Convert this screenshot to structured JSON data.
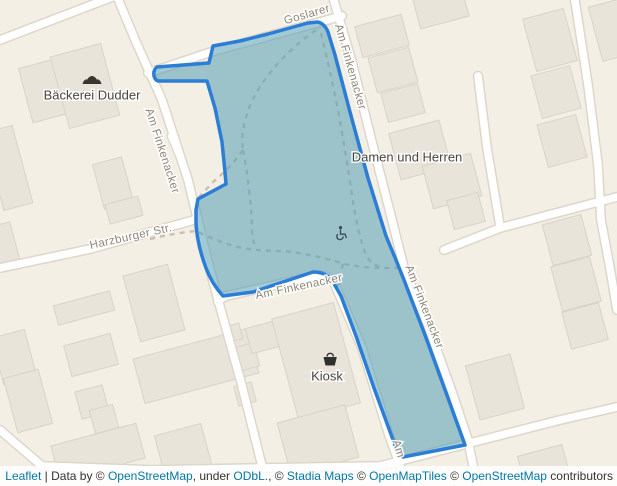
{
  "map": {
    "street_labels": [
      {
        "text": "Goslarer"
      },
      {
        "text": "Am Finkenacker"
      },
      {
        "text": "Am Finkenacker"
      },
      {
        "text": "Am Finkenacker"
      },
      {
        "text": "Am Finkenacker"
      },
      {
        "text": "Am"
      },
      {
        "text": "Harzburger Str."
      }
    ],
    "poi_labels": [
      {
        "text": "Bäckerei Dudder",
        "icon": "bakery-icon"
      },
      {
        "text": "Damen und Herren",
        "icon": "none"
      },
      {
        "text": "Kiosk",
        "icon": "shopping-basket-icon"
      }
    ],
    "icons": [
      {
        "name": "bakery-icon"
      },
      {
        "name": "wheelchair-icon"
      },
      {
        "name": "shopping-basket-icon"
      }
    ]
  },
  "attribution": {
    "parts": [
      {
        "text": "Leaflet",
        "link": true
      },
      {
        "text": " | Data by © ",
        "link": false
      },
      {
        "text": "OpenStreetMap",
        "link": true
      },
      {
        "text": ", under ",
        "link": false
      },
      {
        "text": "ODbL.",
        "link": true
      },
      {
        "text": ", © ",
        "link": false
      },
      {
        "text": "Stadia Maps",
        "link": true
      },
      {
        "text": " © ",
        "link": false
      },
      {
        "text": "OpenMapTiles",
        "link": true
      },
      {
        "text": " © ",
        "link": false
      },
      {
        "text": "OpenStreetMap",
        "link": true
      },
      {
        "text": " contributors",
        "link": false
      }
    ]
  },
  "colors": {
    "land": "#f4efe4",
    "building_fill": "#e9e4da",
    "building_stroke": "#d9d3c7",
    "road_fill": "#ffffff",
    "road_casing": "#ddd7cb",
    "path_dash": "#c8c0b2",
    "highlight_stroke": "#2b7dd6",
    "highlight_fill": "#569fb4",
    "street_label": "#8d8679",
    "poi_label": "#49463f",
    "attribution_text": "#333333",
    "attribution_link": "#0078a8"
  }
}
